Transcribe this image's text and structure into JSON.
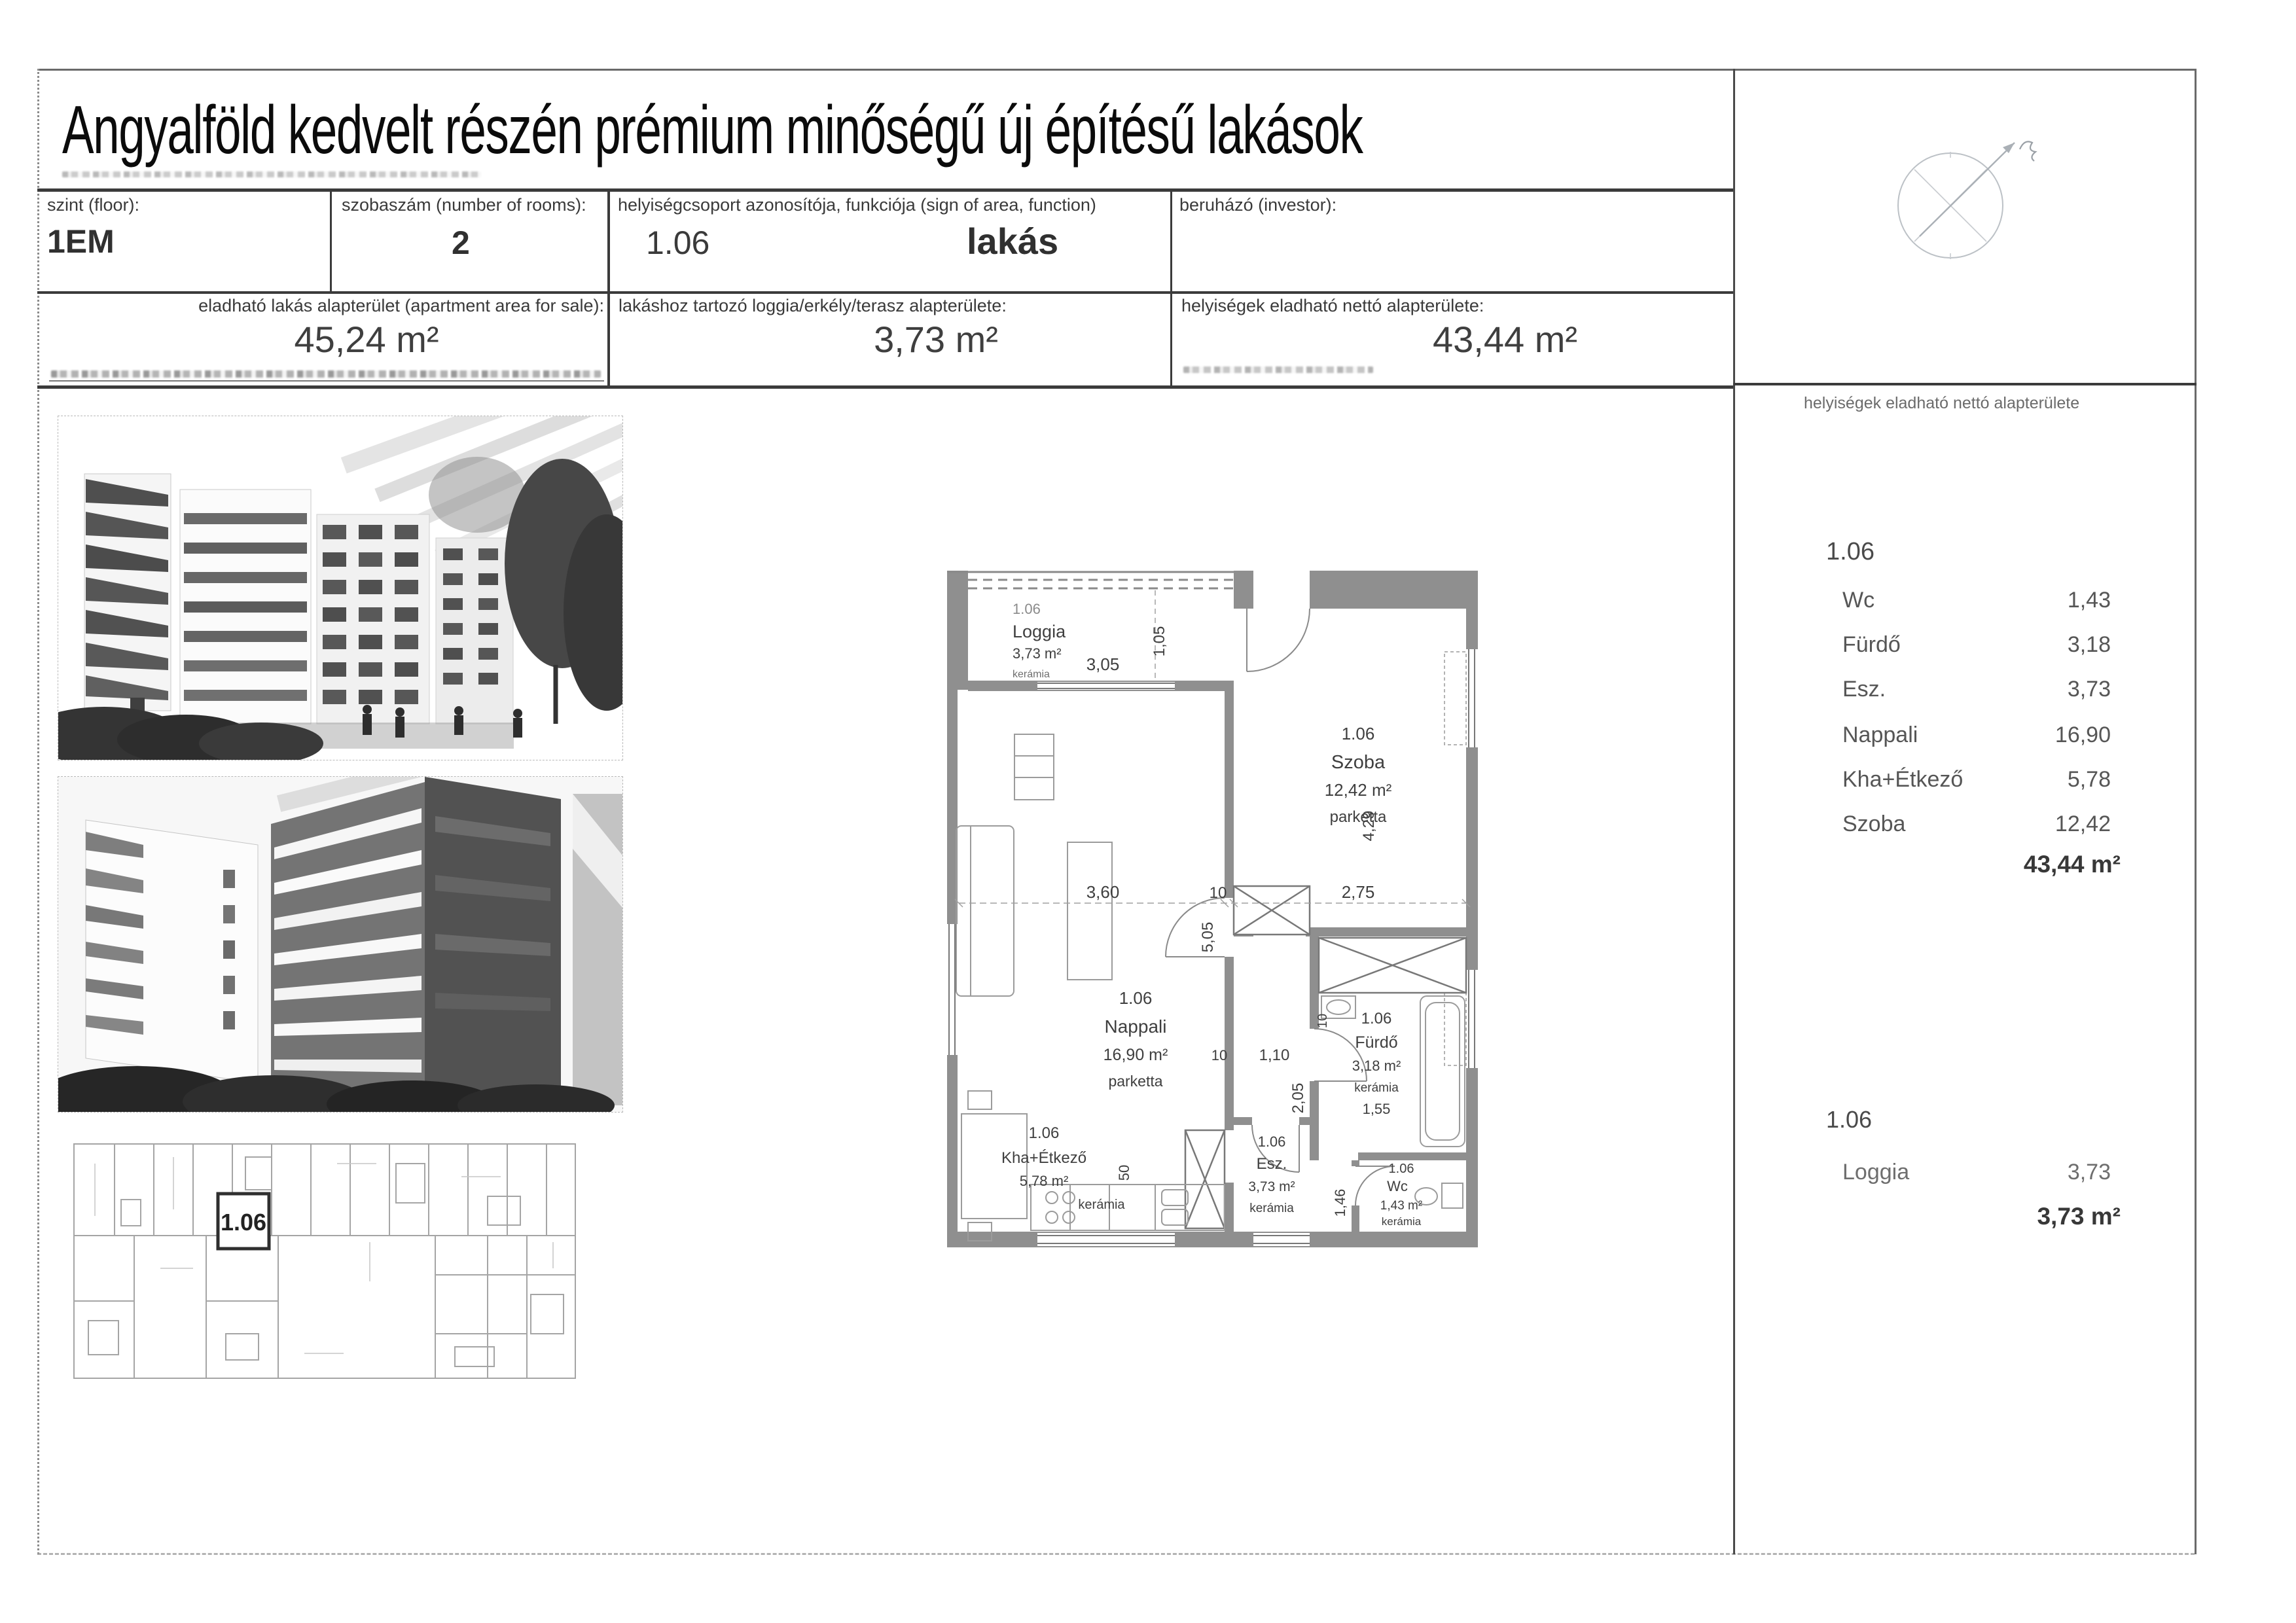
{
  "page": {
    "title": "Angyalföld kedvelt részén prémium minőségű új építésű lakások"
  },
  "header_table": {
    "floor_label": "szint (floor):",
    "floor_value": "1EM",
    "rooms_label": "szobaszám (number of rooms):",
    "rooms_value": "2",
    "unit_label": "helyiségcsoport azonosítója, funkciója (sign of area, function)",
    "unit_id": "1.06",
    "unit_function": "lakás",
    "investor_label": "beruházó (investor):",
    "apartment_area_label": "eladható lakás alapterület (apartment area for sale):",
    "apartment_area_value": "45,24 m²",
    "loggia_area_label": "lakáshoz tartozó loggia/erkély/terasz alapterülete:",
    "loggia_area_value": "3,73 m²",
    "net_area_label": "helyiségek eladható nettó alapterülete:",
    "net_area_value": "43,44 m²"
  },
  "right_panel": {
    "header": "helyiségek eladható nettó alapterülete",
    "unit_id": "1.06",
    "rooms": [
      {
        "name": "Wc",
        "area": "1,43"
      },
      {
        "name": "Fürdő",
        "area": "3,18"
      },
      {
        "name": "Esz.",
        "area": "3,73"
      },
      {
        "name": "Nappali",
        "area": "16,90"
      },
      {
        "name": "Kha+Étkező",
        "area": "5,78"
      },
      {
        "name": "Szoba",
        "area": "12,42"
      }
    ],
    "total": "43,44 m²",
    "loggia_unit_id": "1.06",
    "loggia_name": "Loggia",
    "loggia_area": "3,73",
    "loggia_total": "3,73 m²"
  },
  "floor_plan": {
    "overview_unit_label": "1.06",
    "rooms": {
      "loggia": {
        "id": "1.06",
        "name": "Loggia",
        "area": "3,73 m²",
        "material": "kerámia"
      },
      "szoba": {
        "id": "1.06",
        "name": "Szoba",
        "area": "12,42 m²",
        "material": "parketta"
      },
      "nappali": {
        "id": "1.06",
        "name": "Nappali",
        "area": "16,90 m²",
        "material": "parketta"
      },
      "kha": {
        "id": "1.06",
        "name": "Kha+Étkező",
        "area": "5,78 m²",
        "material": "kerámia"
      },
      "esz": {
        "id": "1.06",
        "name": "Esz.",
        "area": "3,73 m²",
        "material": "kerámia"
      },
      "furdo": {
        "id": "1.06",
        "name": "Fürdő",
        "area": "3,18 m²",
        "material": "kerámia"
      },
      "wc": {
        "id": "1.06",
        "name": "Wc",
        "area": "1,43 m²",
        "material": "kerámia"
      }
    },
    "dims": {
      "loggia_w": "3,05",
      "loggia_d": "1,05",
      "nappali_w": "3,60",
      "gap_a": "10",
      "szoba_w": "2,75",
      "szoba_h": "4,29",
      "nappali_h": "5,05",
      "gap_b": "10",
      "hall_w": "1,10",
      "hall_h": "2,05",
      "gap_c": "10",
      "kha_h": "50",
      "wc_h": "1,46",
      "furdo_w": "1,55"
    }
  }
}
